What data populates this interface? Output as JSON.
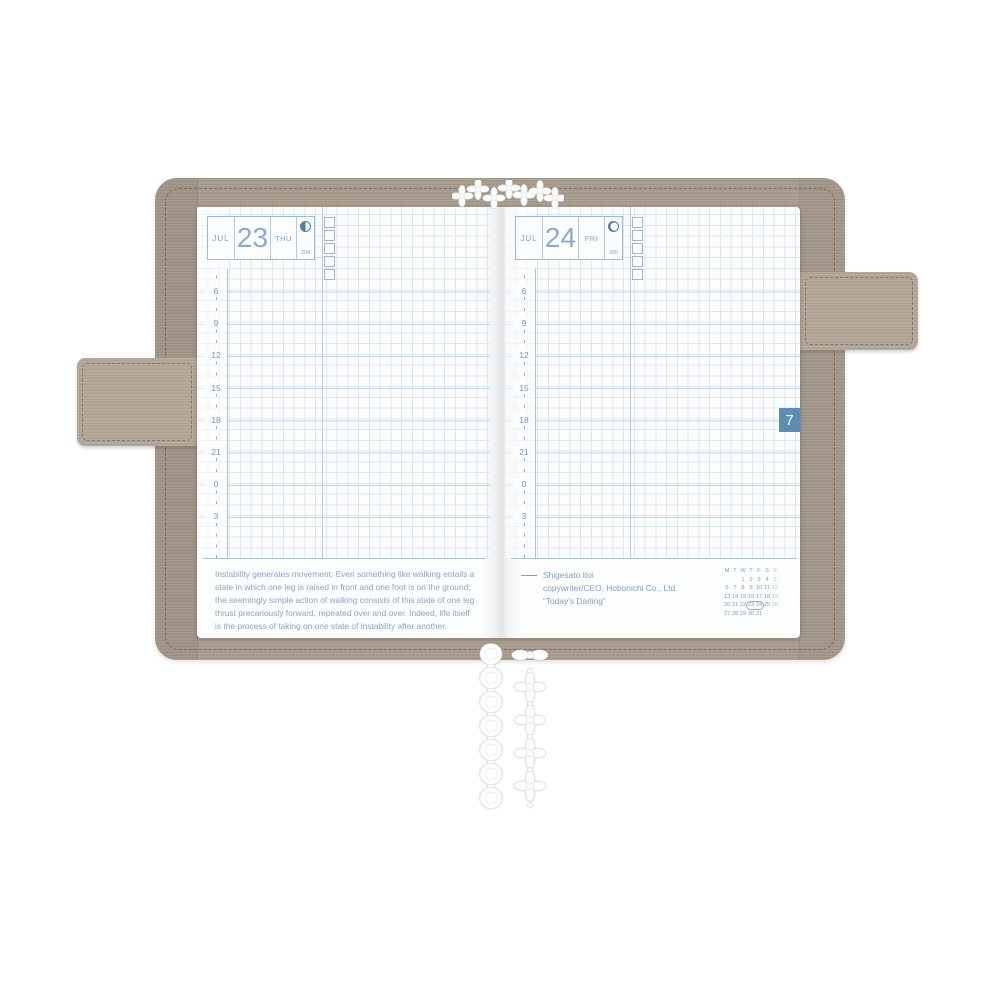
{
  "scene": {
    "background": "#ffffff",
    "subject": "open paper planner in fabric cover"
  },
  "colors": {
    "cover_fabric": "#a89c8e",
    "strap_fabric": "#b3a798",
    "grid_blue": "#dde7f2",
    "accent_blue": "#7da2c9",
    "day_number_blue": "#8aabd0",
    "moon_blue": "#4d7eae",
    "month_tab_blue": "#5d8cb7",
    "quote_text_blue": "#8aa6c5",
    "calendar_sunday_blue": "#b3c7da"
  },
  "pages": {
    "left": {
      "header": {
        "month_label": "JUL",
        "day_number": "23",
        "weekday_label": "THU",
        "day_of_year": "204",
        "moon_phase_icon": "last-quarter-moon"
      },
      "checkbox_count": 5,
      "time_labels": [
        "6",
        "9",
        "12",
        "15",
        "18",
        "21",
        "0",
        "3"
      ],
      "quote_lines": [
        "Instability generates movement. Even something like walking entails a",
        "state in which one leg is raised in front and one foot is on the ground;",
        "the seemingly simple action of walking consists of this state of one leg",
        "thrust precariously forward, repeated over and over. Indeed, life itself",
        "is the process of taking on one state of instability after another."
      ]
    },
    "right": {
      "header": {
        "month_label": "JUL",
        "day_number": "24",
        "weekday_label": "FRI",
        "day_of_year": "205",
        "moon_phase_icon": "waning-crescent-moon"
      },
      "checkbox_count": 5,
      "time_labels": [
        "6",
        "9",
        "12",
        "15",
        "18",
        "21",
        "0",
        "3"
      ],
      "attribution": {
        "dash": "—",
        "author": "Shigesato Itoi",
        "role": "copywriter/CEO, Hobonichi Co., Ltd.",
        "source": "“Today’s Darling”"
      },
      "month_tab": {
        "label": "7",
        "color": "#5d8cb7"
      },
      "mini_calendar": {
        "day_headers": [
          "M",
          "T",
          "W",
          "T",
          "F",
          "S",
          "S"
        ],
        "weeks": [
          [
            "",
            "",
            "1",
            "2",
            "3",
            "4",
            "5"
          ],
          [
            "6",
            "7",
            "8",
            "9",
            "10",
            "11",
            "12"
          ],
          [
            "13",
            "14",
            "15",
            "16",
            "17",
            "18",
            "19"
          ],
          [
            "20",
            "21",
            "22",
            "23",
            "24",
            "25",
            "26"
          ],
          [
            "27",
            "28",
            "29",
            "30",
            "31",
            "",
            ""
          ]
        ],
        "highlighted_days": [
          "23",
          "24"
        ]
      }
    }
  },
  "bookmarks": {
    "top_lace_icon": "lace-trim",
    "ribbon_left_icon": "scallop-lace-ribbon",
    "ribbon_right_icon": "flower-lace-ribbon"
  }
}
